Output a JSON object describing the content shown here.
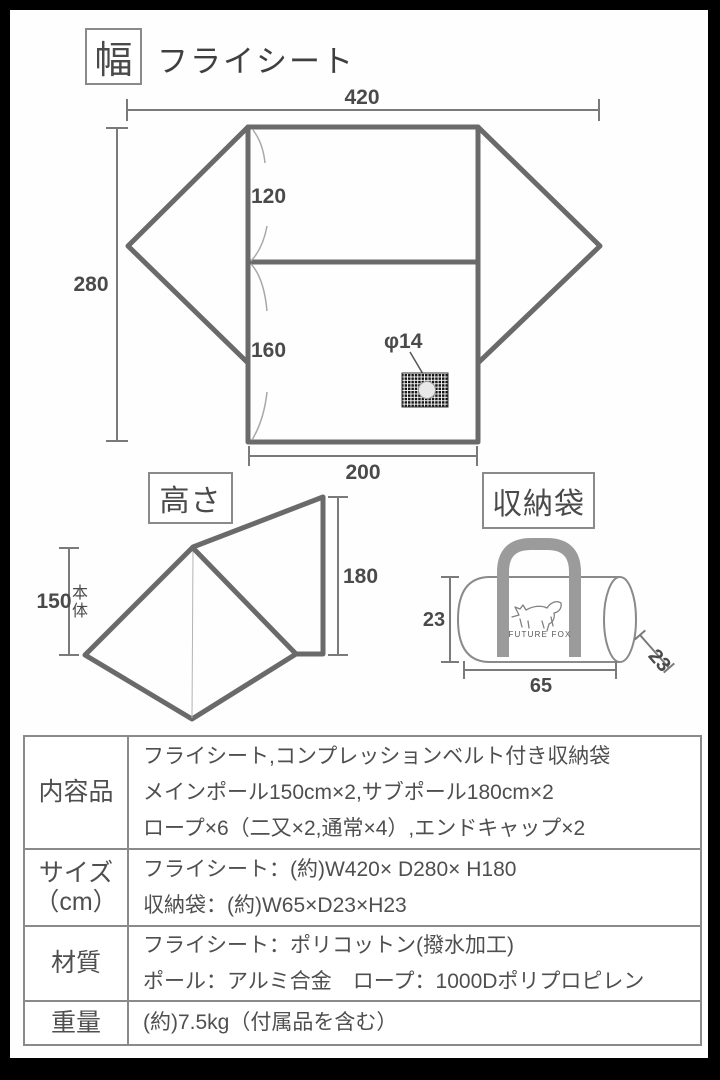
{
  "colors": {
    "frame": "#000000",
    "background": "#ffffff",
    "line_gray": "#6a6a6a",
    "dim_gray": "#7a7a7a",
    "text_gray": "#4a4a4a",
    "border_gray": "#8a8a8a",
    "handle_gray": "#9b9b9b"
  },
  "header": {
    "badge": "幅",
    "title": "フライシート"
  },
  "flysheet": {
    "width_total": "420",
    "depth_total": "280",
    "panel_upper": "120",
    "panel_lower": "160",
    "vent": "φ14",
    "width_bottom": "200"
  },
  "height_section": {
    "badge": "高さ",
    "body_height": "150",
    "body_label": "本体",
    "flap_height": "180"
  },
  "bag_section": {
    "badge": "収納袋",
    "brand": "FUTURE FOX",
    "height": "23",
    "width": "65",
    "depth": "23"
  },
  "spec_table": {
    "rows": [
      {
        "label": "内容品",
        "label2": "",
        "lines": [
          "フライシート,コンプレッションベルト付き収納袋",
          "メインポール150cm×2,サブポール180cm×2",
          "ロープ×6（二又×2,通常×4）,エンドキャップ×2"
        ]
      },
      {
        "label": "サイズ",
        "label2": "（cm）",
        "lines": [
          "フライシート：(約)W420× D280× H180",
          "収納袋：(約)W65×D23×H23"
        ]
      },
      {
        "label": "材質",
        "label2": "",
        "lines": [
          "フライシート：ポリコットン(撥水加工)",
          "ポール：アルミ合金　ロープ：1000Dポリプロピレン"
        ]
      },
      {
        "label": "重量",
        "label2": "",
        "lines": [
          "(約)7.5kg（付属品を含む）"
        ]
      }
    ]
  }
}
